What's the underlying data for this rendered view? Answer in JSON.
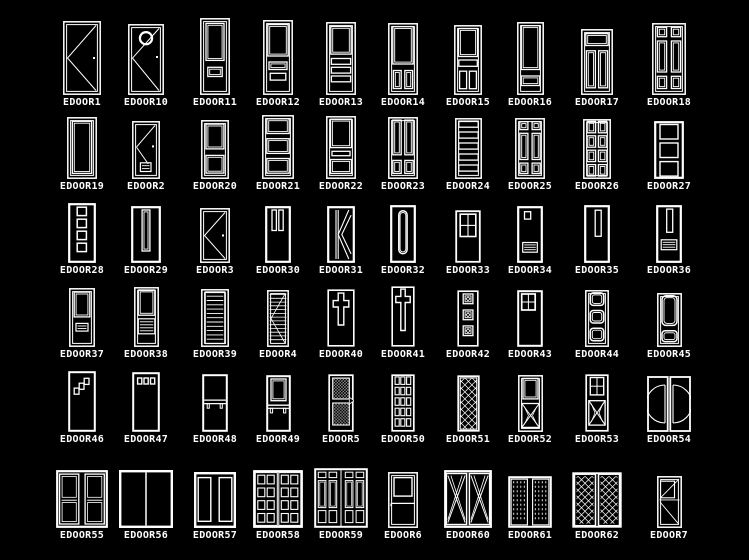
{
  "palette": {
    "background": "#000000",
    "line_color": "#ffffff",
    "label_color": "#ffffff"
  },
  "layout": {
    "columns_x": [
      82,
      146,
      215,
      278,
      341,
      403,
      468,
      530,
      597,
      669
    ],
    "row_door_bottoms": [
      95,
      179,
      263,
      347,
      432,
      528
    ]
  },
  "doors": [
    {
      "label": "EDOOR1",
      "glyph": "swing",
      "row": 0,
      "col": 0,
      "w": 38,
      "h": 74
    },
    {
      "label": "EDOOR10",
      "glyph": "swing-circle",
      "row": 0,
      "col": 1,
      "w": 36,
      "h": 71
    },
    {
      "label": "EDOOR11",
      "glyph": "p-top-slot",
      "row": 0,
      "col": 2,
      "w": 30,
      "h": 77
    },
    {
      "label": "EDOOR12",
      "glyph": "p-sq-2slat",
      "row": 0,
      "col": 3,
      "w": 30,
      "h": 75
    },
    {
      "label": "EDOOR13",
      "glyph": "p-sq-3slat",
      "row": 0,
      "col": 4,
      "w": 30,
      "h": 73
    },
    {
      "label": "EDOOR14",
      "glyph": "p-sq-2vert",
      "row": 0,
      "col": 5,
      "w": 30,
      "h": 72
    },
    {
      "label": "EDOOR15",
      "glyph": "p-sq-slat-2vert",
      "row": 0,
      "col": 6,
      "w": 28,
      "h": 70
    },
    {
      "label": "EDOOR16",
      "glyph": "p-tall-slot",
      "row": 0,
      "col": 7,
      "w": 27,
      "h": 73
    },
    {
      "label": "EDOOR17",
      "glyph": "p-top-2tall",
      "row": 0,
      "col": 8,
      "w": 32,
      "h": 66
    },
    {
      "label": "EDOOR18",
      "glyph": "p-6grid",
      "row": 0,
      "col": 9,
      "w": 34,
      "h": 72
    },
    {
      "label": "EDOOR19",
      "glyph": "p-one",
      "row": 1,
      "col": 0,
      "w": 30,
      "h": 62
    },
    {
      "label": "EDOOR2",
      "glyph": "swing-louver",
      "row": 1,
      "col": 1,
      "w": 28,
      "h": 58
    },
    {
      "label": "EDOOR20",
      "glyph": "p-two",
      "row": 1,
      "col": 2,
      "w": 28,
      "h": 59
    },
    {
      "label": "EDOOR21",
      "glyph": "p-3h",
      "row": 1,
      "col": 3,
      "w": 32,
      "h": 64
    },
    {
      "label": "EDOOR22",
      "glyph": "p-sq-slat-h",
      "row": 1,
      "col": 4,
      "w": 30,
      "h": 63
    },
    {
      "label": "EDOOR23",
      "glyph": "p-2tall-2small",
      "row": 1,
      "col": 5,
      "w": 30,
      "h": 62
    },
    {
      "label": "EDOOR24",
      "glyph": "p-5slat",
      "row": 1,
      "col": 6,
      "w": 27,
      "h": 61
    },
    {
      "label": "EDOOR25",
      "glyph": "p-6grid",
      "row": 1,
      "col": 7,
      "w": 30,
      "h": 61
    },
    {
      "label": "EDOOR26",
      "glyph": "p-8grid",
      "row": 1,
      "col": 8,
      "w": 28,
      "h": 60
    },
    {
      "label": "EDOOR27",
      "glyph": "p-3sq",
      "row": 1,
      "col": 9,
      "w": 30,
      "h": 58
    },
    {
      "label": "EDOOR28",
      "glyph": "sq4-col",
      "row": 2,
      "col": 0,
      "w": 28,
      "h": 60
    },
    {
      "label": "EDOOR29",
      "glyph": "tall-narrow",
      "row": 2,
      "col": 1,
      "w": 30,
      "h": 57
    },
    {
      "label": "EDOOR3",
      "glyph": "swing",
      "row": 2,
      "col": 2,
      "w": 30,
      "h": 55
    },
    {
      "label": "EDOOR30",
      "glyph": "vert2-top",
      "row": 2,
      "col": 3,
      "w": 26,
      "h": 57
    },
    {
      "label": "EDOOR31",
      "glyph": "k-brace",
      "row": 2,
      "col": 4,
      "w": 28,
      "h": 57
    },
    {
      "label": "EDOOR32",
      "glyph": "capsule",
      "row": 2,
      "col": 5,
      "w": 26,
      "h": 58
    },
    {
      "label": "EDOOR33",
      "glyph": "win-cross",
      "row": 2,
      "col": 6,
      "w": 26,
      "h": 53
    },
    {
      "label": "EDOOR34",
      "glyph": "sq-louver",
      "row": 2,
      "col": 7,
      "w": 26,
      "h": 57
    },
    {
      "label": "EDOOR35",
      "glyph": "tall-narrow-hi",
      "row": 2,
      "col": 8,
      "w": 26,
      "h": 58
    },
    {
      "label": "EDOOR36",
      "glyph": "tall-louver",
      "row": 2,
      "col": 9,
      "w": 26,
      "h": 58
    },
    {
      "label": "EDOOR37",
      "glyph": "p-sq-louver-sm",
      "row": 3,
      "col": 0,
      "w": 26,
      "h": 59
    },
    {
      "label": "EDOOR38",
      "glyph": "p-sq-louver",
      "row": 3,
      "col": 1,
      "w": 25,
      "h": 60
    },
    {
      "label": "EDOOR39",
      "glyph": "louver-full",
      "row": 3,
      "col": 2,
      "w": 28,
      "h": 58
    },
    {
      "label": "EDOOR4",
      "glyph": "louver-swing",
      "row": 3,
      "col": 3,
      "w": 22,
      "h": 57
    },
    {
      "label": "EDOOR40",
      "glyph": "cross",
      "row": 3,
      "col": 4,
      "w": 28,
      "h": 58
    },
    {
      "label": "EDOOR41",
      "glyph": "cross-tall",
      "row": 3,
      "col": 5,
      "w": 24,
      "h": 61
    },
    {
      "label": "EDOOR42",
      "glyph": "sq3-dec",
      "row": 3,
      "col": 6,
      "w": 22,
      "h": 57
    },
    {
      "label": "EDOOR43",
      "glyph": "win-2x2",
      "row": 3,
      "col": 7,
      "w": 26,
      "h": 57
    },
    {
      "label": "EDOOR44",
      "glyph": "p-3round",
      "row": 3,
      "col": 8,
      "w": 24,
      "h": 57
    },
    {
      "label": "EDOOR45",
      "glyph": "p-round2",
      "row": 3,
      "col": 9,
      "w": 25,
      "h": 54
    },
    {
      "label": "EDOOR46",
      "glyph": "sq3-stair",
      "row": 4,
      "col": 0,
      "w": 28,
      "h": 61
    },
    {
      "label": "EDOOR47",
      "glyph": "sq3-row",
      "row": 4,
      "col": 1,
      "w": 28,
      "h": 60
    },
    {
      "label": "EDOOR48",
      "glyph": "bar-tabs",
      "row": 4,
      "col": 2,
      "w": 26,
      "h": 58
    },
    {
      "label": "EDOOR49",
      "glyph": "win-bar-tabs",
      "row": 4,
      "col": 3,
      "w": 25,
      "h": 57
    },
    {
      "label": "EDOOR5",
      "glyph": "glass-swing",
      "row": 4,
      "col": 4,
      "w": 26,
      "h": 58
    },
    {
      "label": "EDOOR50",
      "glyph": "grid-5x3",
      "row": 4,
      "col": 5,
      "w": 24,
      "h": 58
    },
    {
      "label": "EDOOR51",
      "glyph": "lattice",
      "row": 4,
      "col": 6,
      "w": 23,
      "h": 57
    },
    {
      "label": "EDOOR52",
      "glyph": "p-xbox",
      "row": 4,
      "col": 7,
      "w": 25,
      "h": 57
    },
    {
      "label": "EDOOR53",
      "glyph": "win-xbox",
      "row": 4,
      "col": 8,
      "w": 24,
      "h": 58
    },
    {
      "label": "EDOOR54",
      "glyph": "dbl-arc",
      "row": 4,
      "col": 9,
      "w": 44,
      "h": 56
    },
    {
      "label": "EDOOR55",
      "glyph": "dbl-2pane",
      "row": 5,
      "col": 0,
      "w": 52,
      "h": 58
    },
    {
      "label": "EDOOR56",
      "glyph": "dbl-plain",
      "row": 5,
      "col": 1,
      "w": 54,
      "h": 58
    },
    {
      "label": "EDOOR57",
      "glyph": "dbl-1pane",
      "row": 5,
      "col": 2,
      "w": 42,
      "h": 56
    },
    {
      "label": "EDOOR58",
      "glyph": "dbl-grid",
      "row": 5,
      "col": 3,
      "w": 50,
      "h": 58
    },
    {
      "label": "EDOOR59",
      "glyph": "dbl-mixed",
      "row": 5,
      "col": 4,
      "w": 54,
      "h": 60
    },
    {
      "label": "EDOOR6",
      "glyph": "win-bar",
      "row": 5,
      "col": 5,
      "w": 30,
      "h": 56
    },
    {
      "label": "EDOOR60",
      "glyph": "dbl-x",
      "row": 5,
      "col": 6,
      "w": 48,
      "h": 58
    },
    {
      "label": "EDOOR61",
      "glyph": "dbl-dashed",
      "row": 5,
      "col": 7,
      "w": 44,
      "h": 52
    },
    {
      "label": "EDOOR62",
      "glyph": "dbl-lattice",
      "row": 5,
      "col": 8,
      "w": 50,
      "h": 56
    },
    {
      "label": "EDOOR7",
      "glyph": "win-diag",
      "row": 5,
      "col": 9,
      "w": 25,
      "h": 52
    }
  ]
}
